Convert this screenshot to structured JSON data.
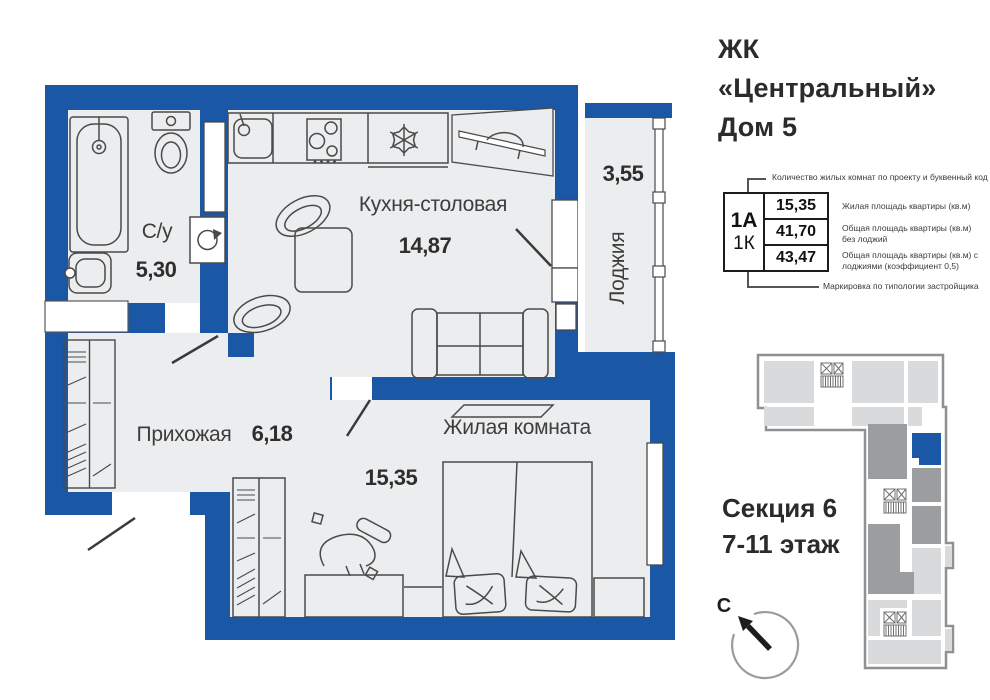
{
  "title": {
    "line1": "ЖК",
    "line2": "«Центральный»",
    "line3": "Дом 5"
  },
  "rooms": {
    "bath": {
      "name": "С/у",
      "area": "5,30"
    },
    "kitchen": {
      "name": "Кухня-столовая",
      "area": "14,87"
    },
    "loggia": {
      "name": "Лоджия",
      "area": "3,55"
    },
    "hall": {
      "name": "Прихожая",
      "area": "6,18"
    },
    "living": {
      "name": "Жилая комната",
      "area": "15,35"
    }
  },
  "spec": {
    "type_code": "1А",
    "room_code": "1К",
    "living_area": "15,35",
    "area_no_loggia": "41,70",
    "area_with_loggia": "43,47",
    "annotation_top": "Количество жилых комнат по проекту и буквенный код",
    "annotation_living": "Жилая площадь квартиры (кв.м)",
    "annotation_no_loggia": "Общая площадь квартиры (кв.м) без лоджий",
    "annotation_with_loggia": "Общая площадь квартиры (кв.м) с лоджиями (коэффициент 0,5)",
    "annotation_bottom": "Маркировка по типологии застройщика"
  },
  "section": {
    "line1": "Секция 6",
    "line2": "7-11 этаж"
  },
  "compass": {
    "north_label": "С"
  },
  "colors": {
    "wall": "#1a57a5",
    "floor": "#ecedee",
    "line": "#4a4a4a",
    "minimap_light": "#d9dadb",
    "minimap_dark": "#9c9d9e",
    "minimap_outline": "#8f9091",
    "highlight_unit": "#1a57a5"
  }
}
